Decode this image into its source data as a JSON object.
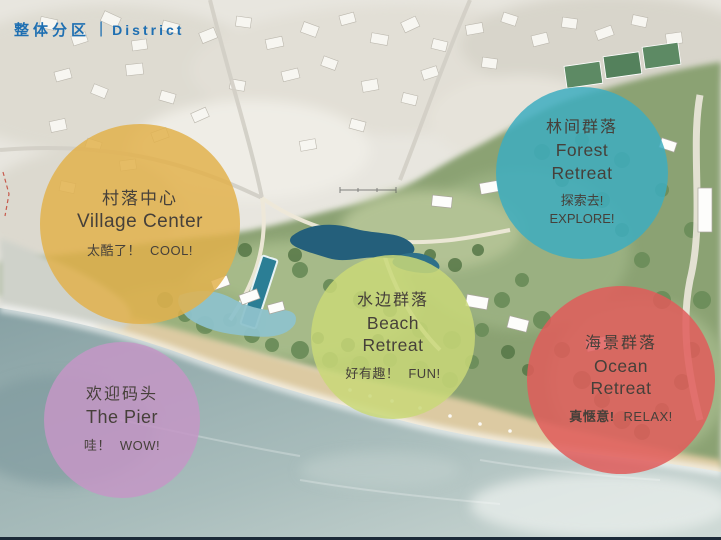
{
  "slide": {
    "title_zh": "整体分区",
    "title_separator": "|",
    "title_en": "District",
    "title_color": "#1e6fb2"
  },
  "districts": [
    {
      "key": "village-center",
      "name_zh": "村落中心",
      "name_en": "Village Center",
      "tagline_zh": "太酷了！",
      "tagline_en": "COOL!",
      "color": "#e2b24c"
    },
    {
      "key": "forest-retreat",
      "name_zh": "林间群落",
      "name_en_line1": "Forest",
      "name_en_line2": "Retreat",
      "tagline_zh": "探索去!",
      "tagline_en": "EXPLORE!",
      "color": "#3dadbf"
    },
    {
      "key": "beach-retreat",
      "name_zh": "水边群落",
      "name_en_line1": "Beach",
      "name_en_line2": "Retreat",
      "tagline_zh": "好有趣！",
      "tagline_en": "FUN!",
      "color": "#c9d878"
    },
    {
      "key": "ocean-retreat",
      "name_zh": "海景群落",
      "name_en_line1": "Ocean",
      "name_en_line2": "Retreat",
      "tagline_zh": "真惬意!",
      "tagline_en": "RELAX!",
      "color": "#e05c5a"
    },
    {
      "key": "the-pier",
      "name_zh": "欢迎码头",
      "name_en": "The Pier",
      "tagline_zh": "哇！",
      "tagline_en": "WOW!",
      "color": "#c497c5"
    }
  ]
}
